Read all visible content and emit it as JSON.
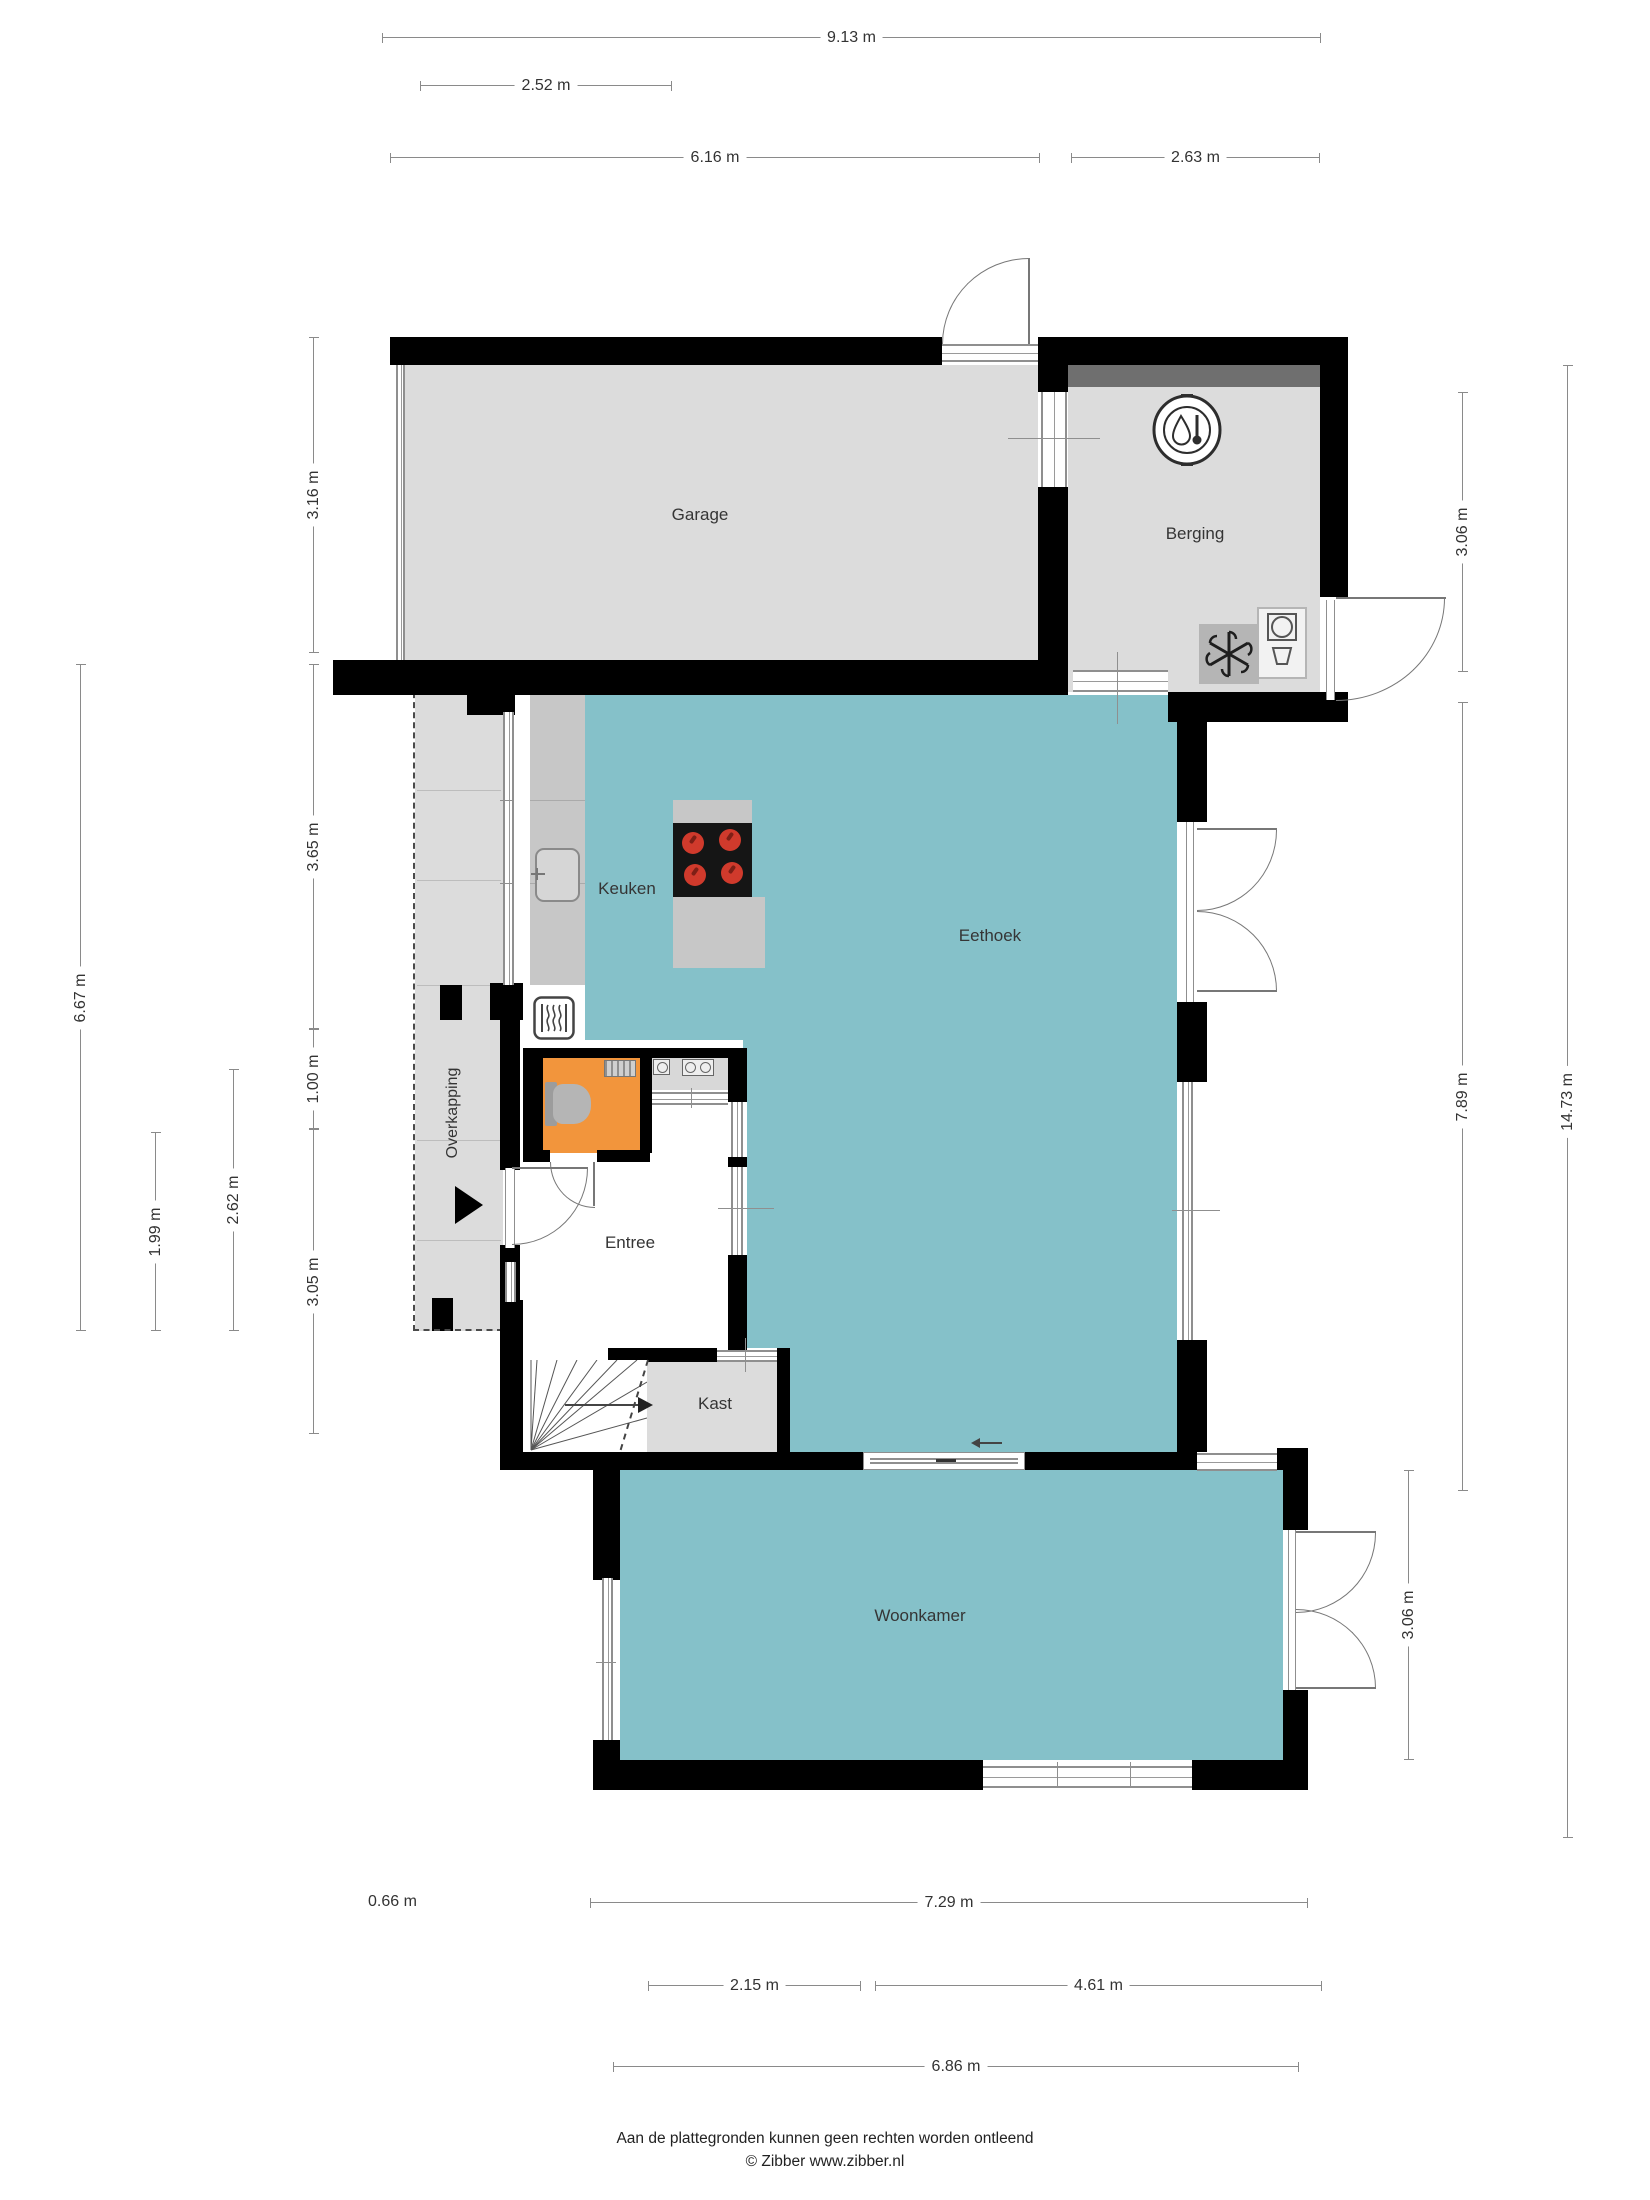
{
  "rooms": {
    "garage": "Garage",
    "berging": "Berging",
    "keuken": "Keuken",
    "eethoek": "Eethoek",
    "entree": "Entree",
    "kast": "Kast",
    "woonkamer": "Woonkamer",
    "overkapping": "Overkapping"
  },
  "dimensions": {
    "top": [
      {
        "label": "9.13 m"
      },
      {
        "label": "2.52 m"
      },
      {
        "label": "6.16 m"
      },
      {
        "label": "2.63 m"
      }
    ],
    "left": [
      {
        "label": "3.16 m"
      },
      {
        "label": "3.65 m"
      },
      {
        "label": "1.00 m"
      },
      {
        "label": "3.05 m"
      },
      {
        "label": "2.62 m"
      },
      {
        "label": "1.99 m"
      },
      {
        "label": "6.67 m"
      }
    ],
    "right": [
      {
        "label": "3.06 m"
      },
      {
        "label": "7.89 m"
      },
      {
        "label": "3.06 m"
      },
      {
        "label": "14.73 m"
      }
    ],
    "bottom": [
      {
        "label": "0.66 m"
      },
      {
        "label": "7.29 m"
      },
      {
        "label": "2.15 m"
      },
      {
        "label": "4.61 m"
      },
      {
        "label": "6.86 m"
      }
    ]
  },
  "icons": [
    "boiler-thermometer-icon",
    "ventilation-fan-icon",
    "washing-machine-icon",
    "radiator-icon",
    "toilet-icon",
    "sink-icon",
    "cooktop-icon",
    "fontein-icon",
    "geiser-icon",
    "stairs",
    "entrance-arrow-icon",
    "slider-arrow-icon"
  ],
  "footer": {
    "line1": "Aan de plattegronden kunnen geen rechten worden ontleend",
    "line2": "© Zibber www.zibber.nl"
  },
  "colors": {
    "teal": "#85c1c9",
    "orange": "#f2953c",
    "roomgray": "#dcdcdc",
    "countergray": "#c7c7c7",
    "darkgray": "#6f6f6f",
    "wall": "#000000",
    "burner": "#d03a2c"
  }
}
